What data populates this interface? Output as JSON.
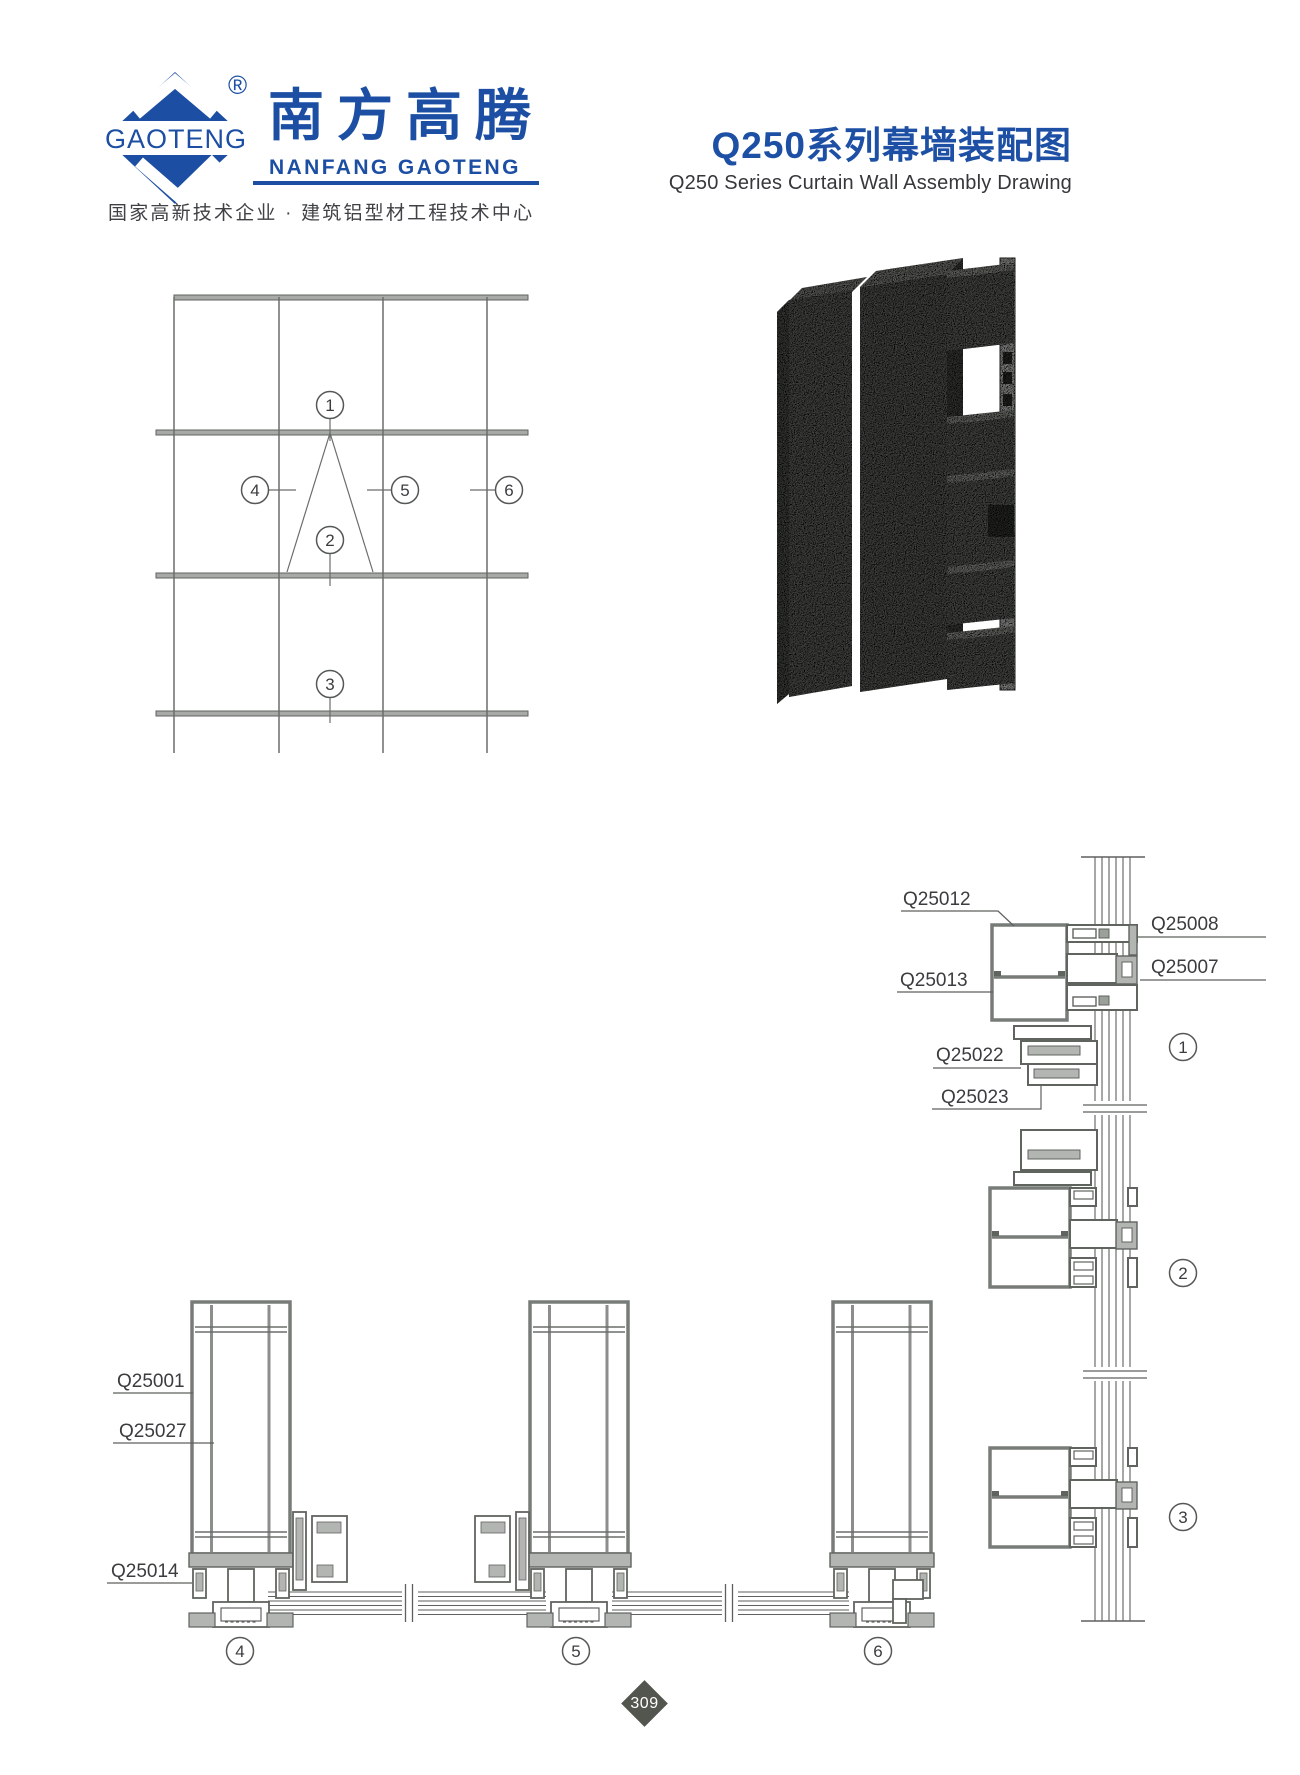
{
  "brand": {
    "logo_mark": "GAOTENG",
    "registered": "®",
    "name_cn": "南方高腾",
    "name_en": "NANFANG GAOTENG",
    "tagline": "国家高新技术企业 · 建筑铝型材工程技术中心",
    "blue": "#1c4fa3"
  },
  "title": {
    "cn": "Q250系列幕墙装配图",
    "en": "Q250 Series Curtain Wall Assembly Drawing"
  },
  "elevation": {
    "callouts": [
      "1",
      "2",
      "3",
      "4",
      "5",
      "6"
    ]
  },
  "vertical_details": {
    "labels": {
      "q25012": "Q25012",
      "q25013": "Q25013",
      "q25022": "Q25022",
      "q25023": "Q25023",
      "q25008": "Q25008",
      "q25007": "Q25007"
    },
    "markers": [
      "1",
      "2",
      "3"
    ]
  },
  "horizontal_details": {
    "labels": {
      "q25001": "Q25001",
      "q25027": "Q25027",
      "q25014": "Q25014"
    },
    "markers": [
      "4",
      "5",
      "6"
    ]
  },
  "footer": {
    "page_number": "309"
  },
  "colors": {
    "line_gray": "#5d615e",
    "wall_gray": "#787c78",
    "fill_gray": "#b2b5b1",
    "band_gray": "#a7aaa7",
    "text_dark": "#3a3c3e",
    "iso_front": "#696c67",
    "iso_side": "#525550",
    "iso_top": "#90938d",
    "alum_face": "#cbcdc9",
    "diamond_bg": "#53564e"
  }
}
